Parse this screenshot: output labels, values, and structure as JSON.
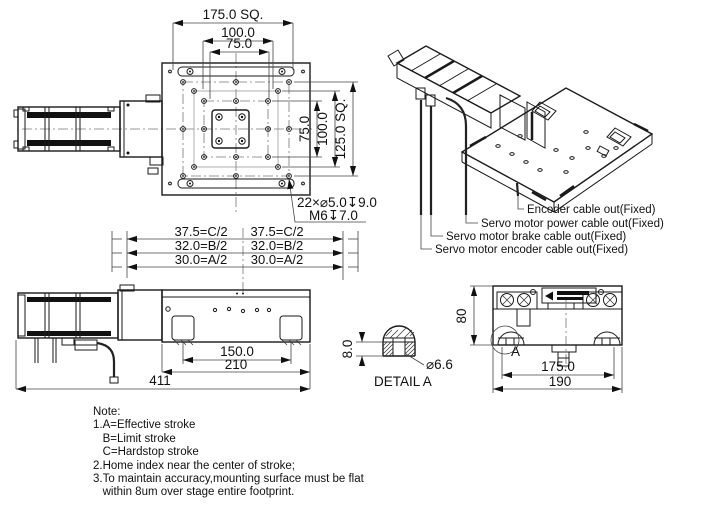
{
  "top_view": {
    "dim_sq": "175.0 SQ.",
    "dim_100": "100.0",
    "dim_75": "75.0",
    "dim_v75": "75.0",
    "dim_v100": "100.0",
    "dim_vsq": "125.0 SQ.",
    "hole_note1": "22×⌀5.0↧9.0",
    "hole_note2": "M6↧7.0"
  },
  "iso_view": {
    "cable_labels": [
      "Encoder cable out(Fixed)",
      "Servo motor power cable out(Fixed)",
      "Servo motor brake cable out(Fixed)",
      "Servo motor encoder cable out(Fixed)"
    ]
  },
  "side_view": {
    "stroke_left": [
      "37.5=C/2",
      "32.0=B/2",
      "30.0=A/2"
    ],
    "stroke_right": [
      "37.5=C/2",
      "32.0=B/2",
      "30.0=A/2"
    ],
    "dim_150": "150.0",
    "dim_210": "210",
    "dim_411": "411"
  },
  "detail_a": {
    "dim_8": "8.0",
    "dim_dia": "⌀6.6",
    "title": "DETAIL A"
  },
  "front_view": {
    "dim_80": "80",
    "dim_175": "175.0",
    "dim_190": "190",
    "detail_marker": "A"
  },
  "notes": {
    "title": "Note:",
    "lines": [
      "1.A=Effective stroke",
      "   B=Limit stroke",
      "   C=Hardstop stroke",
      "2.Home index near the center of stroke;",
      "3.To maintain accuracy,mounting surface must be flat",
      "   within 8um over stage entire footprint."
    ]
  },
  "colors": {
    "line": "#1a1a1a",
    "thin": "#555555",
    "background": "#ffffff"
  }
}
